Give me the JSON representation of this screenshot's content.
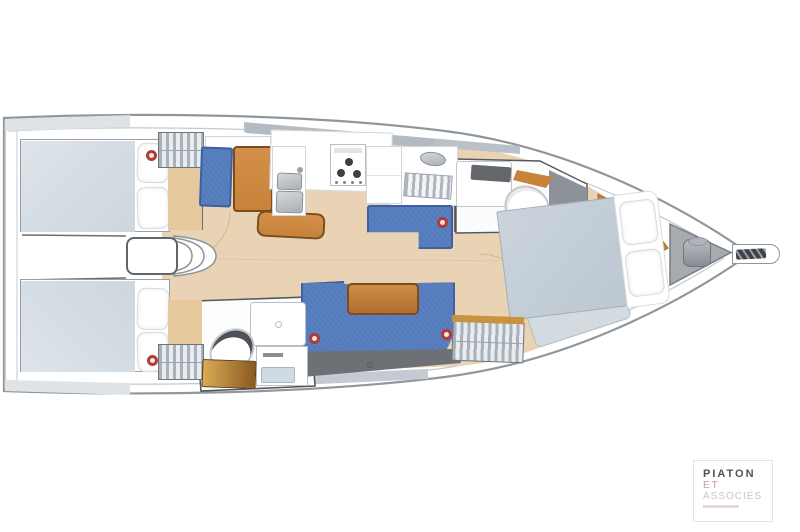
{
  "document": {
    "type": "yacht interior deck plan",
    "orientation": "bow-right"
  },
  "logo": {
    "line1": "PIATON",
    "line2": "ET",
    "line3": "ASSOCIÉS"
  },
  "colors": {
    "hull_outline": "#8f969c",
    "deck_line": "#c3c8cd",
    "wood_floor": "#e9d3b4",
    "wood_dark": "#c8823a",
    "wood_edge": "#7a4c1e",
    "denim_blue": "#5b80c2",
    "denim_shadow": "#3e5fa0",
    "duvet": "#cdd6de",
    "bed_gray": "#d6dee5",
    "wall_dark": "#4e5256",
    "panel_gray": "#8d9298",
    "locker_gray": "#a9b2ba",
    "steel": "#b9bfc5",
    "trim_dark": "#6d7175",
    "accent_red": "#b23b35",
    "deck_insert": "#b3bac2",
    "logo_dark": "#57504b",
    "logo_red": "#c49a9a",
    "logo_light": "#cfc5c1"
  },
  "components": [
    "hull",
    "bowsprit",
    "anchor-locker",
    "windlass",
    "forward-cabin-bed",
    "forward-hanging-locker",
    "forward-head",
    "galley-stove",
    "galley-sink",
    "galley-fridge",
    "galley-dishrack",
    "nav-seat",
    "nav-desk",
    "chart-table",
    "salon-sofa",
    "salon-table",
    "companionway-steps",
    "aft-port-cabin-bed",
    "aft-starboard-cabin-bed",
    "aft-head",
    "wardrobes",
    "door-buttons"
  ]
}
